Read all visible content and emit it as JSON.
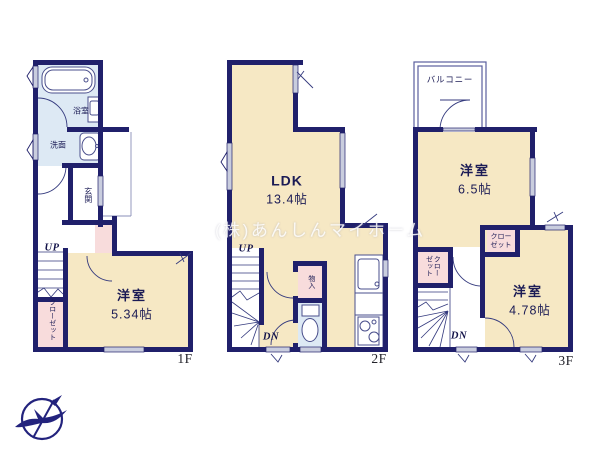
{
  "watermark": "(株)あんしんマイホーム",
  "floor1": {
    "floor_label": "1F",
    "bath": "浴室",
    "washroom": "洗面",
    "entrance": "玄関",
    "closet": "クローゼット",
    "room": "洋室",
    "room_size": "5.34帖",
    "stairs_up": "UP"
  },
  "floor2": {
    "floor_label": "2F",
    "ldk": "LDK",
    "ldk_size": "13.4帖",
    "storage": "物入",
    "stairs_up": "UP",
    "stairs_down": "DN"
  },
  "floor3": {
    "floor_label": "3F",
    "balcony": "バルコニー",
    "room1": "洋室",
    "room1_size": "6.5帖",
    "closet1": "クローゼット",
    "closet2": "クローゼット",
    "room2": "洋室",
    "room2_size": "4.78帖",
    "stairs_down": "DN"
  },
  "colors": {
    "wall": "#20206b",
    "floor_cream": "#f6e8c4",
    "wet_blue": "#dde9f4",
    "closet_pink": "#f8dcdc",
    "logo_navy": "#23237d"
  }
}
